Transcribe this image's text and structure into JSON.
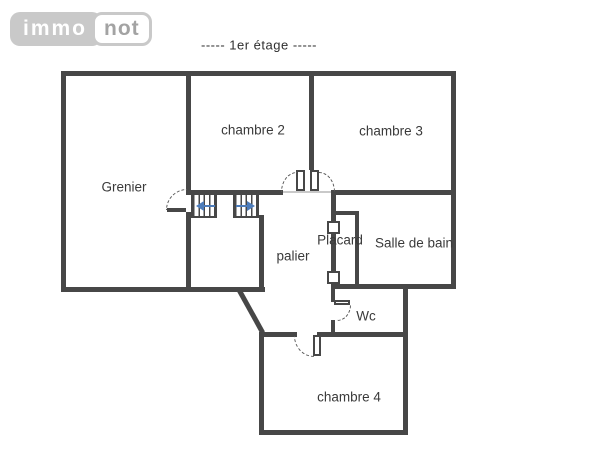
{
  "logo": {
    "immo": "immo",
    "not": "not"
  },
  "title": "----- 1er étage -----",
  "rooms": {
    "grenier": "Grenier",
    "chambre2": "chambre 2",
    "chambre3": "chambre 3",
    "palier": "palier",
    "placard": "Placard",
    "salle_de_bain": "Salle de bain",
    "wc": "Wc",
    "chambre4": "chambre 4"
  },
  "colors": {
    "wall": "#474747",
    "label": "#3a3a3a",
    "stair_arrow": "#4d7cba",
    "logo_gray": "#c9c9c9",
    "logo_text": "#a3a3a3",
    "background": "#ffffff"
  }
}
